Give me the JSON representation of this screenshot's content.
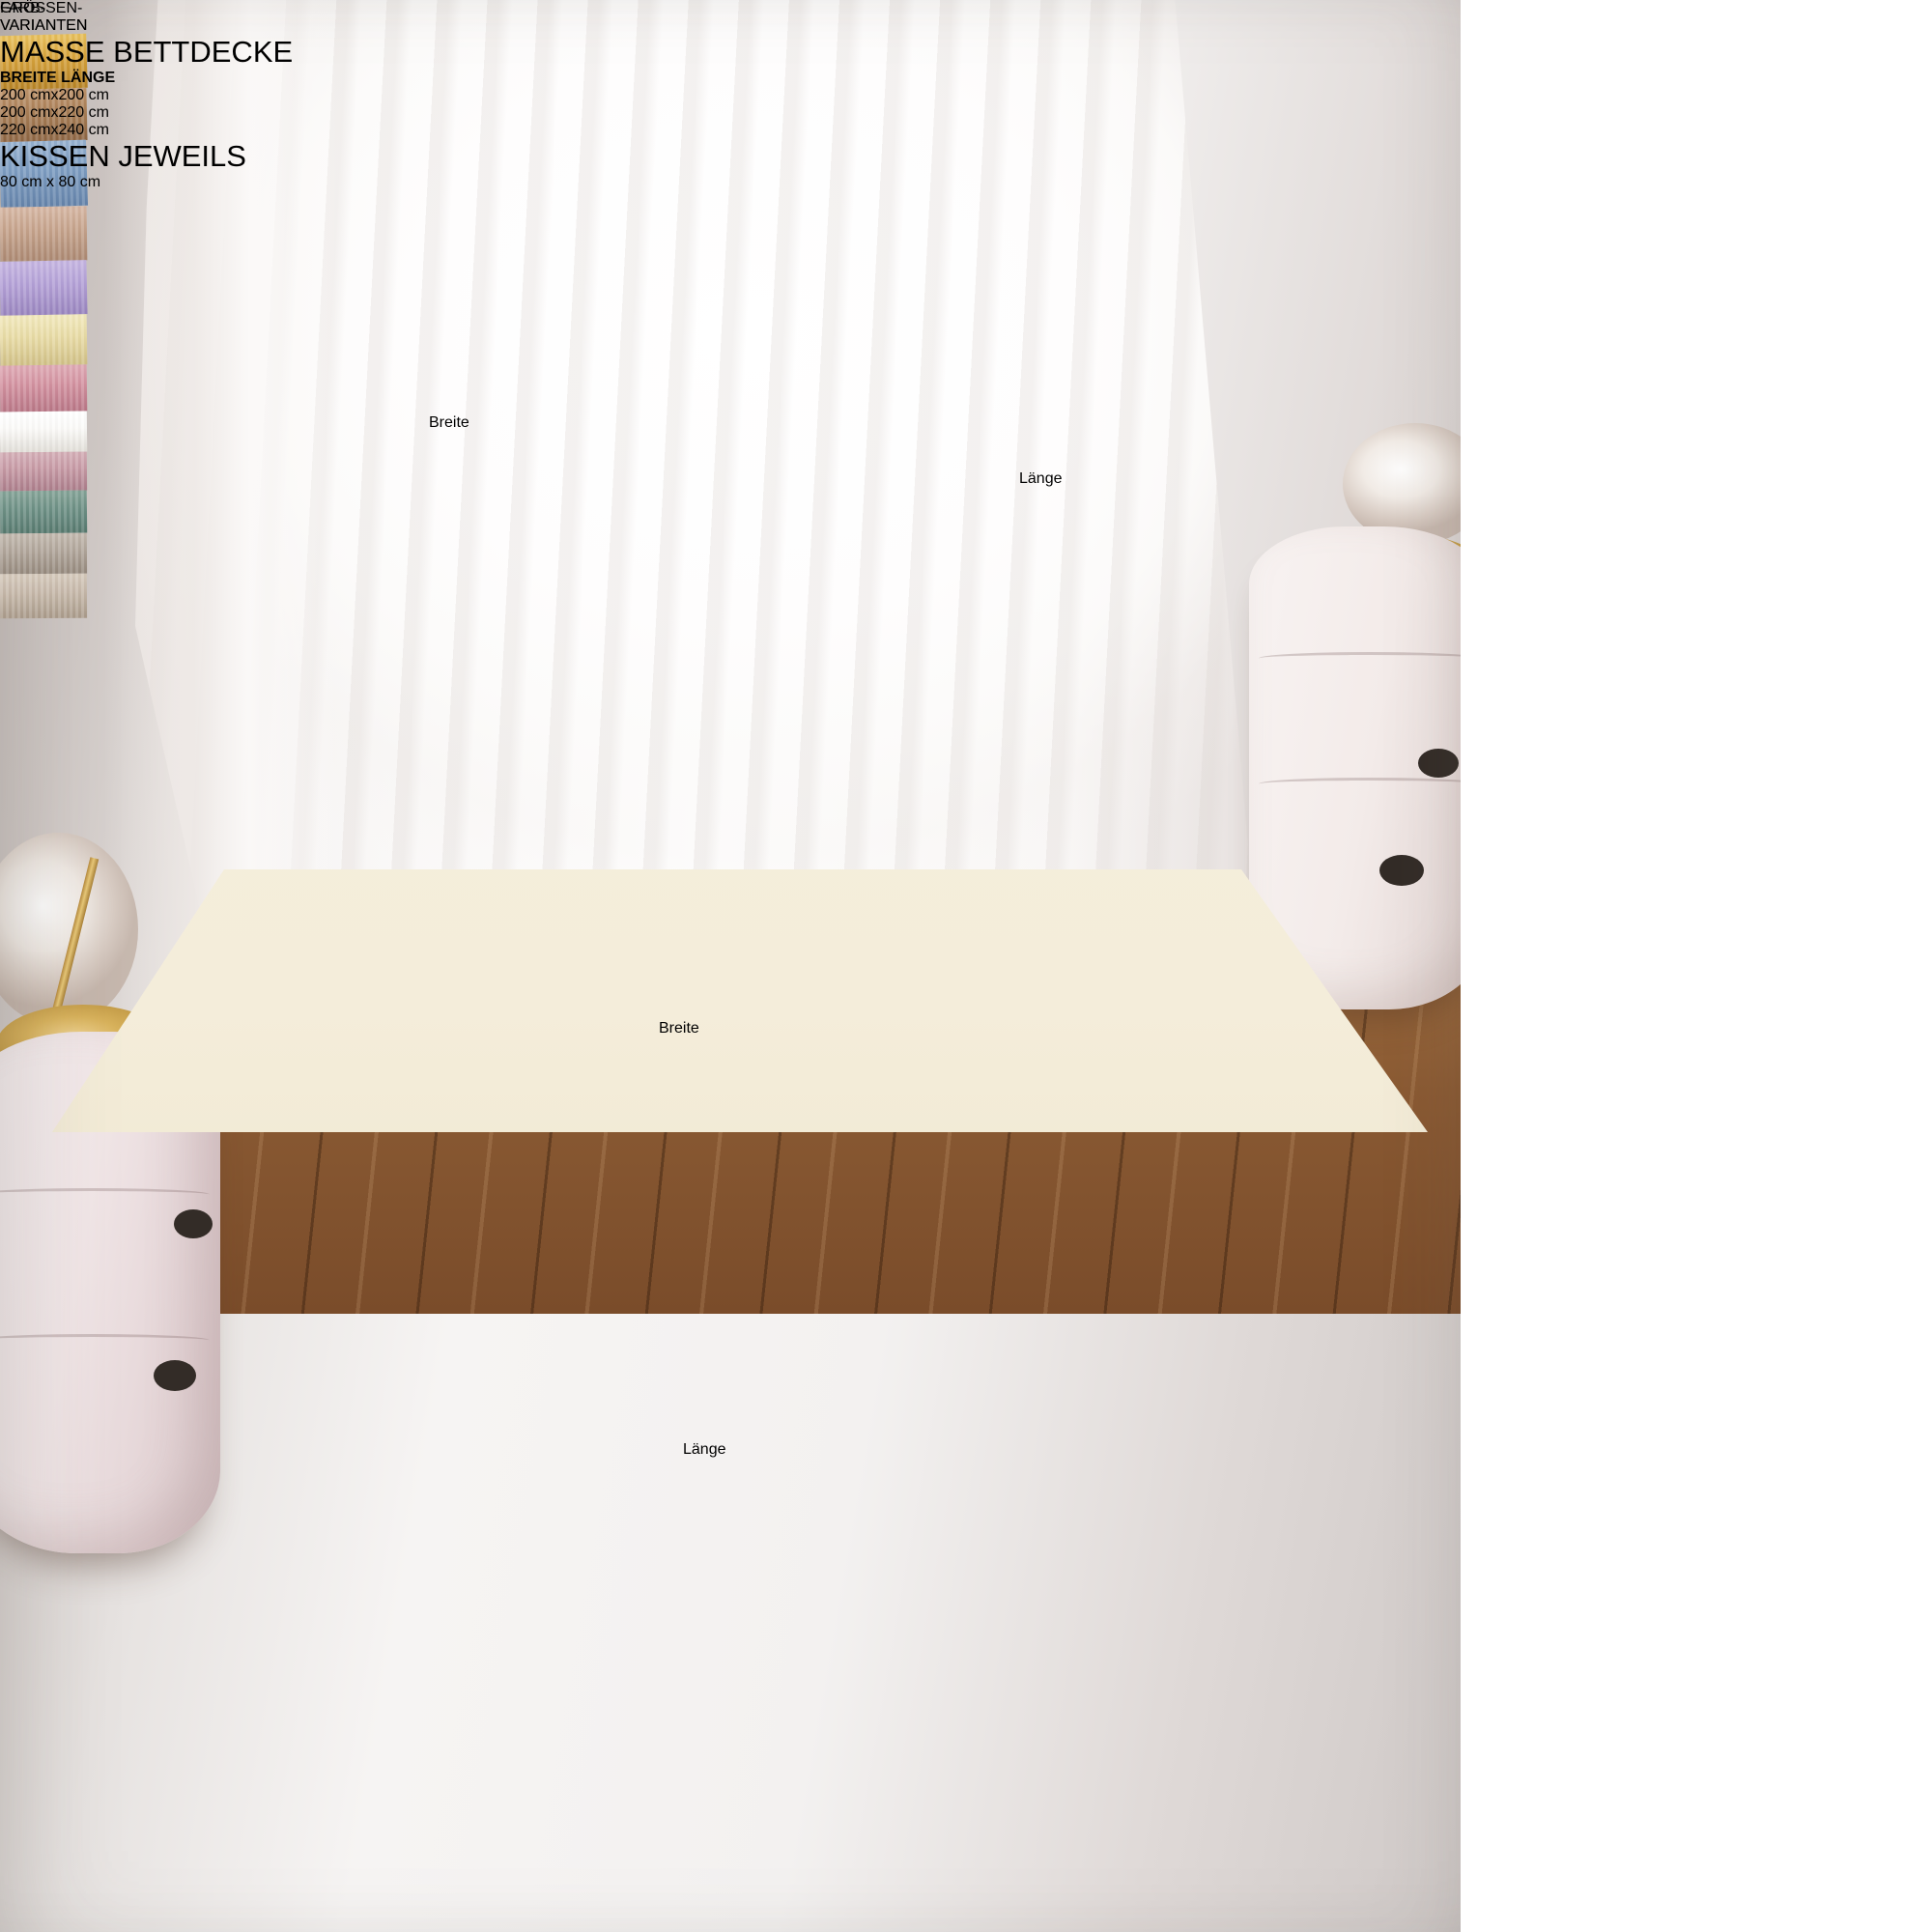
{
  "annotations": {
    "pillow_width_label": "Breite",
    "pillow_length_label": "Länge",
    "bed_width_label": "Breite",
    "bed_length_label": "Länge"
  },
  "color_card": {
    "title_line1": "FARB-",
    "title_line2": "VARIANTEN",
    "fabrics": [
      {
        "name": "mustard",
        "base": "#d7a33c",
        "light": "#e6bd58",
        "dark": "#b98526"
      },
      {
        "name": "camel",
        "base": "#aa8058",
        "light": "#bd9269",
        "dark": "#8f6744"
      },
      {
        "name": "blue",
        "base": "#7d9dc2",
        "light": "#94afce",
        "dark": "#6685ab"
      },
      {
        "name": "beige",
        "base": "#c6a38c",
        "light": "#d4b4a0",
        "dark": "#ad8a73"
      },
      {
        "name": "lavender",
        "base": "#b4a1d7",
        "light": "#c3b2e0",
        "dark": "#9a86c0"
      },
      {
        "name": "cream",
        "base": "#e9dca6",
        "light": "#f1e7ba",
        "dark": "#d2c288"
      },
      {
        "name": "rose",
        "base": "#d392a0",
        "light": "#dda6b1",
        "dark": "#ba7787"
      },
      {
        "name": "white",
        "base": "#fbfaf8",
        "light": "#ffffff",
        "dark": "#e3e0da"
      },
      {
        "name": "mauve",
        "base": "#c79aa5",
        "light": "#d2abb4",
        "dark": "#ad7f8c"
      },
      {
        "name": "sage",
        "base": "#6e9186",
        "light": "#82a195",
        "dark": "#587a6f"
      },
      {
        "name": "taupe",
        "base": "#b1a69b",
        "light": "#c0b6ab",
        "dark": "#978b7f"
      },
      {
        "name": "sand",
        "base": "#c6b8a9",
        "light": "#d3c7b9",
        "dark": "#ab9c8c"
      }
    ]
  },
  "size_card": {
    "title_line1": "GRÖSSEN-",
    "title_line2": "VARIANTEN",
    "subtitle": "MASSE BETTDECKE",
    "col1_header": "BREITE",
    "col2_header": "LÄNGE",
    "separator": "x",
    "rows": [
      {
        "breite": "200 cm",
        "laenge": "200 cm"
      },
      {
        "breite": "200 cm",
        "laenge": "220 cm"
      },
      {
        "breite": "220 cm",
        "laenge": "240 cm"
      }
    ],
    "pillow_label": "KISSEN JEWEILS",
    "pillow_row": {
      "breite": "80 cm",
      "laenge": "80 cm"
    }
  },
  "colors": {
    "panel_bg": "#f5e2d3",
    "card_bg": "#fbf8f3",
    "annotation_bg": "#ffffff",
    "annotation_text": "#141414",
    "title_text": "#1b1b1b",
    "duvet": "#b7a794",
    "sheet": "#f4edda",
    "floor": "#8a5a33"
  }
}
